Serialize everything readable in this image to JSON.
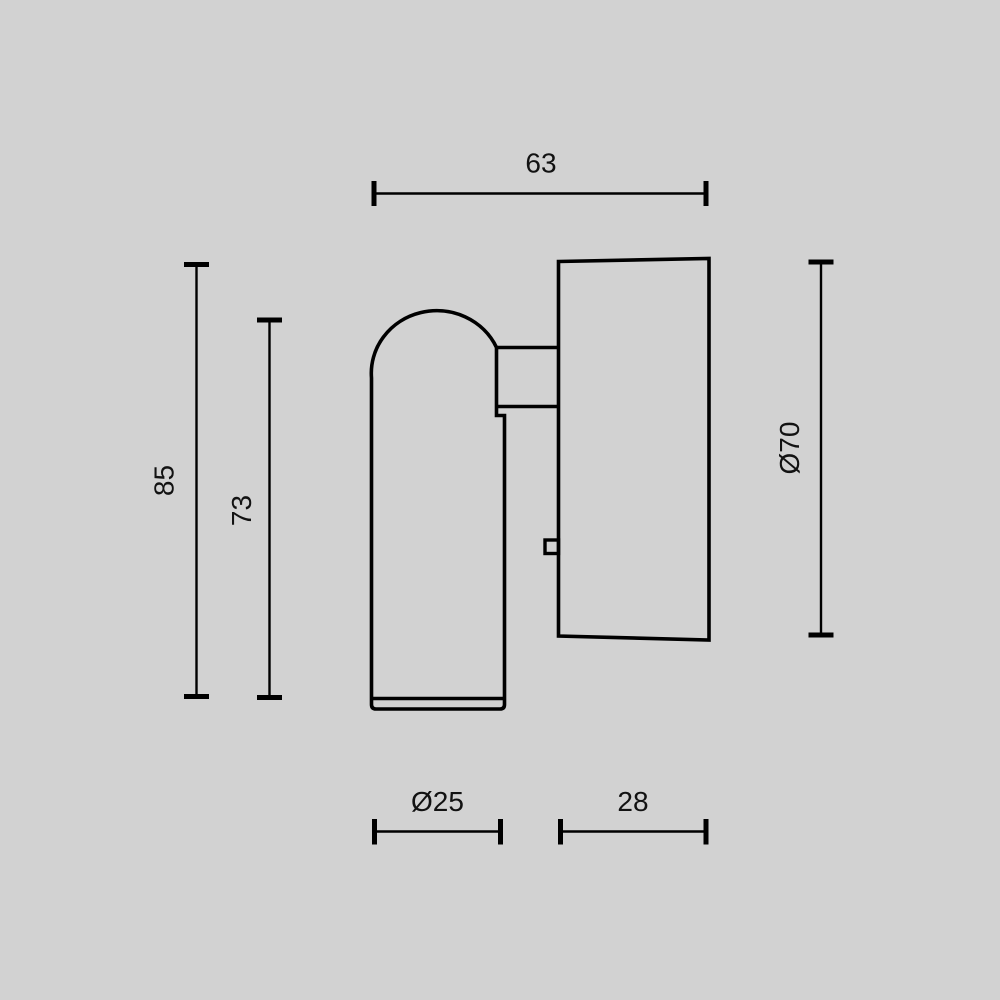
{
  "canvas": {
    "background": "#d2d2d2",
    "line_color": "#000000",
    "text_color": "#121212"
  },
  "dimensions": {
    "top_width": {
      "label": "63",
      "value": 63,
      "orientation": "horizontal"
    },
    "overall_height": {
      "label": "85",
      "value": 85,
      "orientation": "vertical"
    },
    "head_height": {
      "label": "73",
      "value": 73,
      "orientation": "vertical"
    },
    "cup_diameter": {
      "label": "Ø70",
      "value": 70,
      "orientation": "vertical"
    },
    "head_diameter": {
      "label": "Ø25",
      "value": 25,
      "orientation": "horizontal"
    },
    "mount_depth": {
      "label": "28",
      "value": 28,
      "orientation": "horizontal"
    }
  }
}
